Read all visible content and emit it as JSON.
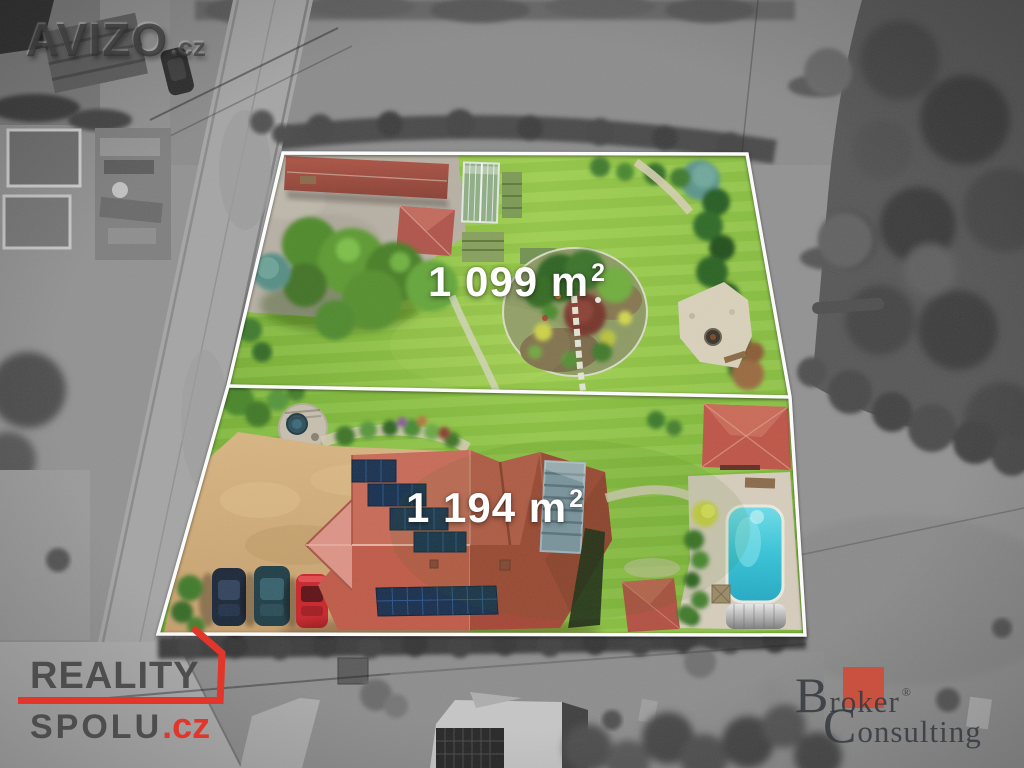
{
  "plot_labels": {
    "upper": {
      "value": "1 099 m",
      "sup": "2"
    },
    "lower": {
      "value": "1 194 m",
      "sup": "2"
    }
  },
  "watermarks": {
    "avizo": {
      "name": "AVIZO",
      "tld": ".cz"
    },
    "reality_spolu": {
      "line1": "REALITY",
      "line2": "SPOLU",
      "tld": ".cz"
    },
    "broker_consulting": {
      "cap1": "B",
      "seg1": "r",
      "highlight": "ok",
      "seg2": "er",
      "registered": "®",
      "cap2": "C",
      "seg3": "onsulting"
    }
  },
  "colors": {
    "boundary_line": "#ffffff",
    "reality_accent": "#e2362b",
    "broker_square": "#cb4f3b",
    "lawn_green": "#85bd3c",
    "roof_red": "#c05a4a",
    "pool_turquoise": "#35c3d6"
  }
}
